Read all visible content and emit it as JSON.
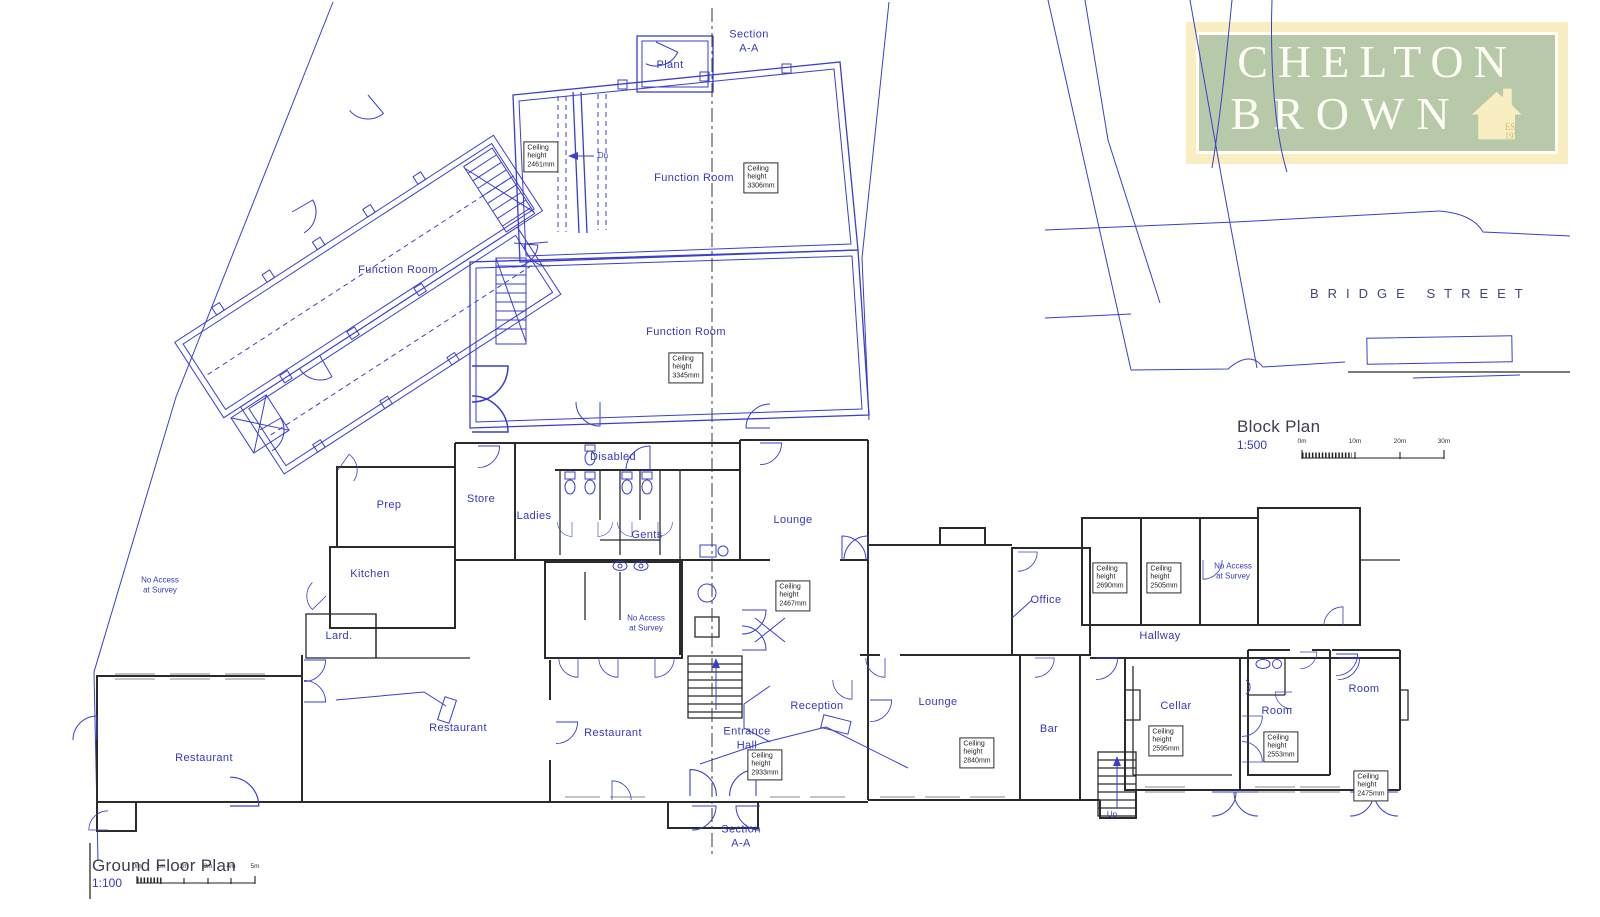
{
  "colors": {
    "blue": "#3a3ecf",
    "wall": "#2b2b2b",
    "label": "#3437c4",
    "cream": "#f8eec2",
    "green": "#b7c9a8",
    "title": "#3d3d52"
  },
  "logo": {
    "line1": "CHELTON",
    "line2": "BROWN",
    "est": "EST.\n1975"
  },
  "block_plan": {
    "title": "Block Plan",
    "scale": "1:500",
    "street": "BRIDGE  STREET",
    "ticks": [
      {
        "label": "0m",
        "x": 1302,
        "y": 445
      },
      {
        "label": "10m",
        "x": 1355,
        "y": 445
      },
      {
        "label": "20m",
        "x": 1400,
        "y": 445
      },
      {
        "label": "30m",
        "x": 1444,
        "y": 445
      }
    ]
  },
  "ground_floor_plan": {
    "title": "Ground Floor Plan",
    "scale": "1:100",
    "ticks": [
      {
        "label": "0m",
        "x": 137,
        "y": 870
      },
      {
        "label": "1m",
        "x": 161,
        "y": 870
      },
      {
        "label": "2m",
        "x": 184,
        "y": 870
      },
      {
        "label": "3m",
        "x": 208,
        "y": 870
      },
      {
        "label": "4m",
        "x": 231,
        "y": 870
      },
      {
        "label": "5m",
        "x": 255,
        "y": 870
      }
    ]
  },
  "section_labels": [
    {
      "name": "top",
      "label": "Section\nA-A",
      "x": 749,
      "y": 42
    },
    {
      "name": "bottom",
      "label": "Section\nA-A",
      "x": 741,
      "y": 837
    }
  ],
  "room_labels": [
    {
      "name": "plant",
      "label": "Plant",
      "x": 670,
      "y": 66
    },
    {
      "name": "function-room-top",
      "label": "Function Room",
      "x": 694,
      "y": 179
    },
    {
      "name": "function-room-left",
      "label": "Function Room",
      "x": 398,
      "y": 271
    },
    {
      "name": "function-room-center",
      "label": "Function Room",
      "x": 686,
      "y": 333
    },
    {
      "name": "disabled",
      "label": "Disabled",
      "x": 613,
      "y": 458
    },
    {
      "name": "prep",
      "label": "Prep",
      "x": 389,
      "y": 506
    },
    {
      "name": "store",
      "label": "Store",
      "x": 481,
      "y": 500
    },
    {
      "name": "ladies",
      "label": "Ladies",
      "x": 534,
      "y": 517
    },
    {
      "name": "gents",
      "label": "Gents",
      "x": 647,
      "y": 536
    },
    {
      "name": "lounge-upper",
      "label": "Lounge",
      "x": 793,
      "y": 521
    },
    {
      "name": "kitchen",
      "label": "Kitchen",
      "x": 370,
      "y": 575
    },
    {
      "name": "office",
      "label": "Office",
      "x": 1046,
      "y": 601
    },
    {
      "name": "lard",
      "label": "Lard.",
      "x": 339,
      "y": 637
    },
    {
      "name": "hallway",
      "label": "Hallway",
      "x": 1160,
      "y": 637
    },
    {
      "name": "cellar",
      "label": "Cellar",
      "x": 1176,
      "y": 707
    },
    {
      "name": "room-center",
      "label": "Room",
      "x": 1277,
      "y": 712
    },
    {
      "name": "room-right",
      "label": "Room",
      "x": 1364,
      "y": 690
    },
    {
      "name": "lounge-lower",
      "label": "Lounge",
      "x": 938,
      "y": 703
    },
    {
      "name": "reception",
      "label": "Reception",
      "x": 817,
      "y": 707
    },
    {
      "name": "bar",
      "label": "Bar",
      "x": 1049,
      "y": 730
    },
    {
      "name": "restaurant-left",
      "label": "Restaurant",
      "x": 204,
      "y": 759
    },
    {
      "name": "restaurant-center",
      "label": "Restaurant",
      "x": 458,
      "y": 729
    },
    {
      "name": "restaurant-right",
      "label": "Restaurant",
      "x": 613,
      "y": 734
    },
    {
      "name": "entrance-hall",
      "label": "Entrance\nHall",
      "x": 747,
      "y": 739
    }
  ],
  "annotations": [
    {
      "name": "no-access-left",
      "label": "No Access\nat Survey",
      "x": 160,
      "y": 586
    },
    {
      "name": "no-access-center",
      "label": "No Access\nat Survey",
      "x": 646,
      "y": 624
    },
    {
      "name": "no-access-right",
      "label": "No Access\nat Survey",
      "x": 1233,
      "y": 572
    },
    {
      "name": "stair-down",
      "label": "Dn",
      "x": 603,
      "y": 156
    },
    {
      "name": "stair-up",
      "label": "Up",
      "x": 1112,
      "y": 815
    }
  ],
  "ceiling_notes": [
    {
      "x": 541,
      "y": 157,
      "lines": [
        "Ceiling",
        "height",
        "2461mm"
      ]
    },
    {
      "x": 761,
      "y": 178,
      "lines": [
        "Ceiling",
        "height",
        "3306mm"
      ]
    },
    {
      "x": 686,
      "y": 368,
      "lines": [
        "Ceiling",
        "height",
        "3345mm"
      ]
    },
    {
      "x": 793,
      "y": 596,
      "lines": [
        "Ceiling",
        "height",
        "2467mm"
      ]
    },
    {
      "x": 1110,
      "y": 578,
      "lines": [
        "Ceiling",
        "height",
        "2690mm"
      ]
    },
    {
      "x": 1164,
      "y": 578,
      "lines": [
        "Ceiling",
        "height",
        "2505mm"
      ]
    },
    {
      "x": 1166,
      "y": 741,
      "lines": [
        "Ceiling",
        "height",
        "2595mm"
      ]
    },
    {
      "x": 1281,
      "y": 747,
      "lines": [
        "Ceiling",
        "height",
        "2553mm"
      ]
    },
    {
      "x": 1371,
      "y": 786,
      "lines": [
        "Ceiling",
        "height",
        "2475mm"
      ]
    },
    {
      "x": 765,
      "y": 765,
      "lines": [
        "Ceiling",
        "height",
        "2933mm"
      ]
    },
    {
      "x": 977,
      "y": 753,
      "lines": [
        "Ceiling",
        "height",
        "2840mm"
      ]
    }
  ]
}
